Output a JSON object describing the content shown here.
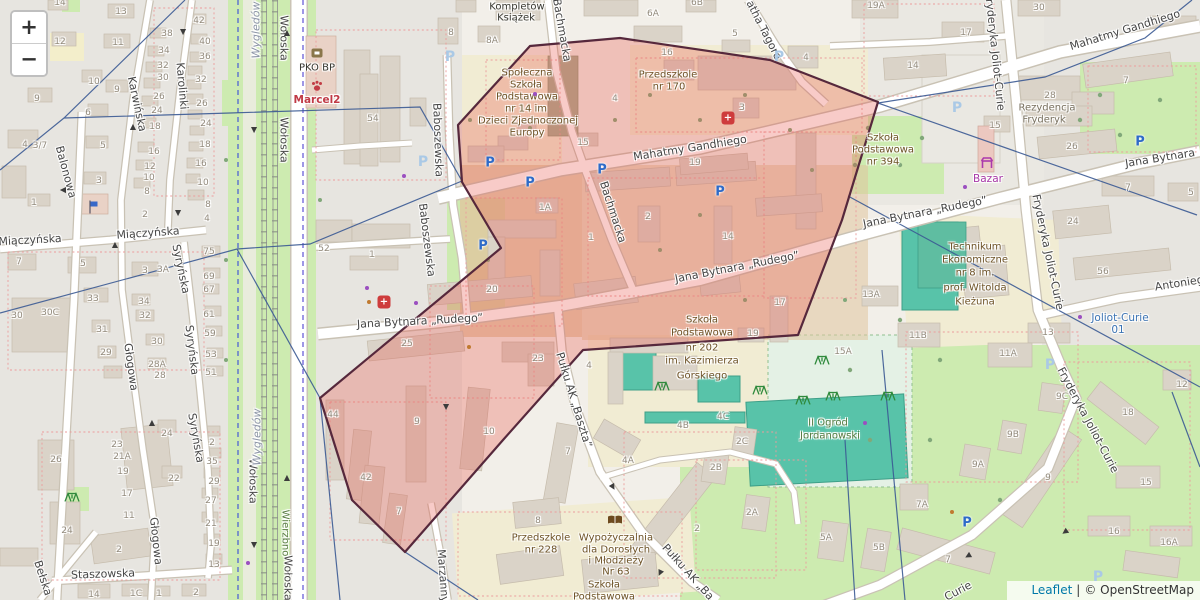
{
  "controls": {
    "zoom_in": "+",
    "zoom_out": "−"
  },
  "attribution": {
    "leaflet": "Leaflet",
    "separator": "|",
    "copyright": "© OpenStreetMap"
  },
  "overlay": {
    "fill": "rgba(232,82,72,0.30)",
    "stroke": "#56283c"
  },
  "accent_colors": {
    "parking_blue": "#2e6bc8",
    "pharmacy_red": "#ce3c3c",
    "shop_purple": "#a839a8",
    "vet_red": "#c03a46",
    "transit_blue": "#3c74b4",
    "poi_brown": "#6d5226",
    "boundary_navy": "#3b5a94"
  },
  "map": {
    "street_labels": [
      [
        "Wołoska",
        284,
        38,
        90
      ],
      [
        "Wołoska",
        284,
        140,
        90
      ],
      [
        "Wołoska",
        253,
        481,
        90
      ],
      [
        "Wołoska",
        288,
        578,
        90
      ],
      [
        "Mahatmy Gandhiego",
        690,
        148,
        -9
      ],
      [
        "Mahatmy Gandhiego",
        1125,
        30,
        -17
      ],
      [
        "Jana Bytnara „Rudego”",
        420,
        321,
        -3
      ],
      [
        "Jana Bytnara „Rudego”",
        737,
        267,
        -11
      ],
      [
        "Jana Bytnara „Rudego”",
        925,
        212,
        -11
      ],
      [
        "Jana Bytnara",
        1160,
        158,
        -9
      ],
      [
        "Baboszewska",
        438,
        140,
        88
      ],
      [
        "Baboszewska",
        427,
        240,
        83
      ],
      [
        "Bachmacka",
        562,
        30,
        80
      ],
      [
        "Bachmacka",
        613,
        212,
        72
      ],
      [
        "Karwińska",
        137,
        104,
        78
      ],
      [
        "Karolinki",
        182,
        86,
        85
      ],
      [
        "Balonowa",
        66,
        172,
        75
      ],
      [
        "Miączyńska",
        30,
        240,
        -3
      ],
      [
        "Miączyńska",
        148,
        233,
        -4
      ],
      [
        "Syryńska",
        181,
        269,
        78
      ],
      [
        "Syryńska",
        192,
        350,
        83
      ],
      [
        "Syryńska",
        196,
        438,
        80
      ],
      [
        "Głogowa",
        131,
        367,
        82
      ],
      [
        "Głogowa",
        156,
        541,
        84
      ],
      [
        "Staszowska",
        103,
        574,
        -2
      ],
      [
        "Bełska",
        43,
        578,
        72
      ],
      [
        "Marzanny",
        443,
        576,
        86
      ],
      [
        "Pułku AK „Baszta”",
        574,
        400,
        73
      ],
      [
        "Pułku AK „Ba",
        688,
        572,
        48
      ],
      [
        "Fryderyka Joliot-Curie",
        995,
        52,
        84
      ],
      [
        "Fryderyka Joliot-Curie",
        1048,
        252,
        78
      ],
      [
        "Fryderyka Joliot-Curie",
        1088,
        420,
        62
      ],
      [
        "Curie",
        958,
        591,
        -28
      ],
      [
        "Antoniego Malczewskiego",
        1225,
        276,
        -9
      ],
      [
        "atha Tagore",
        764,
        30,
        63
      ]
    ],
    "place_labels": [
      [
        "Kompletów",
        517,
        7,
        "k"
      ],
      [
        "Książek",
        516,
        18,
        "k"
      ],
      [
        "Społeczna",
        527,
        73,
        "p"
      ],
      [
        "Szkoła",
        526,
        85,
        "p"
      ],
      [
        "Podstawowa",
        527,
        97,
        "p"
      ],
      [
        "nr 14 im",
        526,
        109,
        "p"
      ],
      [
        "Dzieci Zjednoczonej",
        528,
        121,
        "p"
      ],
      [
        "Europy",
        527,
        133,
        "p"
      ],
      [
        "Przedszkole",
        668,
        75,
        "p"
      ],
      [
        "nr 170",
        669,
        87,
        "p"
      ],
      [
        "Szkoła",
        883,
        138,
        "p"
      ],
      [
        "Podstawowa",
        883,
        150,
        "p"
      ],
      [
        "nr 394",
        883,
        162,
        "p"
      ],
      [
        "Rezydencja",
        1047,
        108,
        "gr"
      ],
      [
        "Fryderyk",
        1044,
        120,
        "gr"
      ],
      [
        "Technikum",
        975,
        247,
        "p"
      ],
      [
        "Ekonomiczne",
        975,
        260,
        "p"
      ],
      [
        "nr 8 im.",
        975,
        273,
        "p"
      ],
      [
        "prof. Witolda",
        975,
        288,
        "p"
      ],
      [
        "Kieżuna",
        975,
        302,
        "p"
      ],
      [
        "Szkoła",
        702,
        320,
        "p"
      ],
      [
        "Podstawowa",
        702,
        333,
        "p"
      ],
      [
        "nr 202",
        702,
        348,
        "p"
      ],
      [
        "im. Kazimierza",
        702,
        361,
        "p"
      ],
      [
        "Górskiego",
        702,
        376,
        "p"
      ],
      [
        "II Ogród",
        828,
        423,
        "g"
      ],
      [
        "Jordanowski",
        830,
        436,
        "g"
      ],
      [
        "Przedszkole",
        541,
        538,
        "p"
      ],
      [
        "nr 228",
        541,
        550,
        "p"
      ],
      [
        "Wypożyczalnia",
        616,
        538,
        "p"
      ],
      [
        "dla Dorosłych",
        616,
        550,
        "p"
      ],
      [
        "i Młodzieży",
        616,
        561,
        "p"
      ],
      [
        "Nr 63",
        616,
        572,
        "p"
      ],
      [
        "Szkoła",
        604,
        585,
        "p"
      ],
      [
        "Podstawowa",
        604,
        597,
        "p"
      ],
      [
        "PKO BP",
        317,
        68,
        "k"
      ],
      [
        "Marcel2",
        317,
        100,
        "r"
      ],
      [
        "Bazar",
        988,
        179,
        "m"
      ],
      [
        "Joliot-Curie",
        1120,
        318,
        "b"
      ],
      [
        "01",
        1118,
        330,
        "b"
      ],
      [
        "Wierzbno",
        285,
        533,
        "g",
        90
      ],
      [
        "Wygledów",
        256,
        30,
        "n",
        -90
      ],
      [
        "Wygledów",
        257,
        437,
        "n",
        -90
      ]
    ],
    "building_numbers": [
      [
        "14",
        60,
        3
      ],
      [
        "13",
        121,
        12
      ],
      [
        "12",
        60,
        42
      ],
      [
        "11",
        118,
        43
      ],
      [
        "10",
        94,
        82
      ],
      [
        "9",
        117,
        90
      ],
      [
        "9",
        37,
        99
      ],
      [
        "6",
        88,
        113
      ],
      [
        "5",
        103,
        146
      ],
      [
        "3",
        99,
        181
      ],
      [
        "4",
        25,
        145
      ],
      [
        "3/7",
        40,
        146
      ],
      [
        "1",
        34,
        203
      ],
      [
        "2",
        145,
        215
      ],
      [
        "8",
        208,
        205
      ],
      [
        "4",
        207,
        219
      ],
      [
        "38",
        167,
        34
      ],
      [
        "34",
        164,
        51
      ],
      [
        "32",
        163,
        66
      ],
      [
        "30",
        163,
        78
      ],
      [
        "26",
        159,
        97
      ],
      [
        "24",
        157,
        111
      ],
      [
        "18",
        155,
        127
      ],
      [
        "16",
        154,
        152
      ],
      [
        "12",
        150,
        167
      ],
      [
        "10",
        149,
        178
      ],
      [
        "8",
        147,
        192
      ],
      [
        "42",
        199,
        21
      ],
      [
        "40",
        205,
        42
      ],
      [
        "36",
        205,
        57
      ],
      [
        "32",
        201,
        80
      ],
      [
        "26",
        202,
        104
      ],
      [
        "24",
        206,
        124
      ],
      [
        "18",
        205,
        145
      ],
      [
        "16",
        201,
        164
      ],
      [
        "10",
        203,
        183
      ],
      [
        "7",
        19,
        262
      ],
      [
        "5",
        83,
        264
      ],
      [
        "3",
        145,
        271
      ],
      [
        "3A",
        163,
        270
      ],
      [
        "33",
        93,
        299
      ],
      [
        "30C",
        50,
        313
      ],
      [
        "30",
        17,
        316
      ],
      [
        "34",
        144,
        302
      ],
      [
        "32",
        145,
        316
      ],
      [
        "31",
        102,
        330
      ],
      [
        "30",
        157,
        342
      ],
      [
        "29",
        106,
        353
      ],
      [
        "28A",
        157,
        365
      ],
      [
        "28",
        160,
        376
      ],
      [
        "75",
        209,
        252
      ],
      [
        "69",
        209,
        277
      ],
      [
        "67",
        209,
        290
      ],
      [
        "61",
        209,
        315
      ],
      [
        "59",
        210,
        334
      ],
      [
        "53",
        211,
        355
      ],
      [
        "51",
        211,
        373
      ],
      [
        "26",
        56,
        460
      ],
      [
        "23",
        117,
        445
      ],
      [
        "21A",
        122,
        457
      ],
      [
        "19",
        123,
        472
      ],
      [
        "17",
        127,
        494
      ],
      [
        "11",
        129,
        516
      ],
      [
        "24",
        67,
        531
      ],
      [
        "2",
        119,
        550
      ],
      [
        "24",
        167,
        434
      ],
      [
        "22",
        174,
        479
      ],
      [
        "35",
        212,
        462
      ],
      [
        "29",
        214,
        482
      ],
      [
        "27",
        211,
        501
      ],
      [
        "21",
        211,
        524
      ],
      [
        "19",
        214,
        544
      ],
      [
        "13",
        214,
        565
      ],
      [
        "2",
        212,
        443
      ],
      [
        "14",
        94,
        595
      ],
      [
        "1C",
        136,
        594
      ],
      [
        "1",
        159,
        594
      ],
      [
        "2",
        196,
        593
      ],
      [
        "54",
        373,
        119
      ],
      [
        "52",
        324,
        249
      ],
      [
        "1",
        372,
        255
      ],
      [
        "8",
        451,
        33
      ],
      [
        "8A",
        492,
        41
      ],
      [
        "5",
        735,
        34
      ],
      [
        "6A",
        653,
        14
      ],
      [
        "6B",
        697,
        3
      ],
      [
        "15",
        583,
        143
      ],
      [
        "4",
        615,
        99
      ],
      [
        "16",
        667,
        53
      ],
      [
        "1A",
        545,
        208
      ],
      [
        "1",
        591,
        238
      ],
      [
        "2",
        648,
        217
      ],
      [
        "19",
        695,
        163
      ],
      [
        "14",
        728,
        237
      ],
      [
        "20",
        492,
        290
      ],
      [
        "25",
        407,
        344
      ],
      [
        "23",
        538,
        359
      ],
      [
        "44",
        333,
        415
      ],
      [
        "42",
        366,
        478
      ],
      [
        "7",
        399,
        512
      ],
      [
        "9",
        417,
        422
      ],
      [
        "10",
        489,
        432
      ],
      [
        "19",
        753,
        334
      ],
      [
        "17",
        780,
        303
      ],
      [
        "3",
        742,
        108
      ],
      [
        "4",
        589,
        366
      ],
      [
        "4B",
        683,
        426
      ],
      [
        "4C",
        723,
        417
      ],
      [
        "2C",
        742,
        442
      ],
      [
        "2B",
        716,
        468
      ],
      [
        "2A",
        752,
        513
      ],
      [
        "2",
        697,
        529
      ],
      [
        "5A",
        826,
        538
      ],
      [
        "5B",
        879,
        548
      ],
      [
        "7A",
        922,
        505
      ],
      [
        "7",
        948,
        560
      ],
      [
        "4A",
        628,
        461
      ],
      [
        "7",
        568,
        452
      ],
      [
        "8",
        538,
        521
      ],
      [
        "15A",
        843,
        352
      ],
      [
        "13A",
        871,
        295
      ],
      [
        "19A",
        876,
        6
      ],
      [
        "17",
        966,
        33
      ],
      [
        "14",
        913,
        66
      ],
      [
        "4",
        806,
        58
      ],
      [
        "30",
        1039,
        8
      ],
      [
        "15",
        995,
        126
      ],
      [
        "28",
        1050,
        96
      ],
      [
        "26",
        1072,
        147
      ],
      [
        "7",
        1126,
        81
      ],
      [
        "7",
        1128,
        188
      ],
      [
        "5",
        1191,
        193
      ],
      [
        "24",
        1073,
        222
      ],
      [
        "56",
        1103,
        272
      ],
      [
        "13",
        1048,
        333
      ],
      [
        "11A",
        1008,
        354
      ],
      [
        "11B",
        918,
        336
      ],
      [
        "9C",
        1062,
        397
      ],
      [
        "9B",
        1013,
        435
      ],
      [
        "9A",
        978,
        465
      ],
      [
        "9",
        1048,
        478
      ],
      [
        "18",
        1128,
        413
      ],
      [
        "12",
        1182,
        385
      ],
      [
        "15",
        1146,
        483
      ],
      [
        "16",
        1114,
        532
      ],
      [
        "16A",
        1169,
        543
      ]
    ],
    "icons": [
      [
        "pb",
        490,
        163
      ],
      [
        "pb",
        530,
        183
      ],
      [
        "pb",
        602,
        170
      ],
      [
        "pb",
        720,
        192
      ],
      [
        "pb",
        483,
        246
      ],
      [
        "pb",
        1140,
        142
      ],
      [
        "pb",
        967,
        523
      ],
      [
        "pp",
        423,
        162
      ],
      [
        "pp",
        450,
        57
      ],
      [
        "pp",
        779,
        57
      ],
      [
        "pp",
        957,
        108
      ],
      [
        "pp",
        1050,
        365
      ],
      [
        "pp",
        1098,
        577
      ],
      [
        "ph",
        728,
        118
      ],
      [
        "ph",
        384,
        302
      ],
      [
        "bank",
        317,
        53
      ],
      [
        "paw",
        317,
        86
      ],
      [
        "stall",
        987,
        163
      ],
      [
        "book",
        615,
        520
      ],
      [
        "flag",
        93,
        207
      ],
      [
        "play",
        760,
        390
      ],
      [
        "play",
        803,
        400
      ],
      [
        "play",
        833,
        396
      ],
      [
        "play",
        888,
        396
      ],
      [
        "play",
        822,
        360
      ],
      [
        "play",
        662,
        386
      ],
      [
        "play",
        72,
        497
      ],
      [
        "ar",
        287,
        33,
        0
      ],
      [
        "ar",
        287,
        478,
        0
      ],
      [
        "ar",
        133,
        127,
        0
      ],
      [
        "ar",
        115,
        245,
        0
      ],
      [
        "ar",
        152,
        423,
        0
      ],
      [
        "ar",
        254,
        130,
        180
      ],
      [
        "ar",
        254,
        545,
        180
      ],
      [
        "ar",
        183,
        32,
        180
      ],
      [
        "ar",
        178,
        213,
        180
      ],
      [
        "ar",
        446,
        407,
        180
      ],
      [
        "ar",
        660,
        573,
        205
      ],
      [
        "ar",
        613,
        487,
        150
      ],
      [
        "ar",
        63,
        190,
        270
      ],
      [
        "ar",
        1065,
        532,
        235
      ],
      [
        "ar",
        968,
        556,
        240
      ],
      [
        "dp",
        367,
        288
      ],
      [
        "dp",
        416,
        303
      ],
      [
        "dp",
        535,
        94
      ],
      [
        "dp",
        404,
        176
      ],
      [
        "dp",
        1080,
        317
      ],
      [
        "dp",
        865,
        423
      ],
      [
        "dp",
        248,
        563
      ],
      [
        "dp",
        965,
        187
      ],
      [
        "do",
        469,
        347
      ],
      [
        "do",
        952,
        512
      ],
      [
        "do",
        369,
        302
      ]
    ]
  }
}
